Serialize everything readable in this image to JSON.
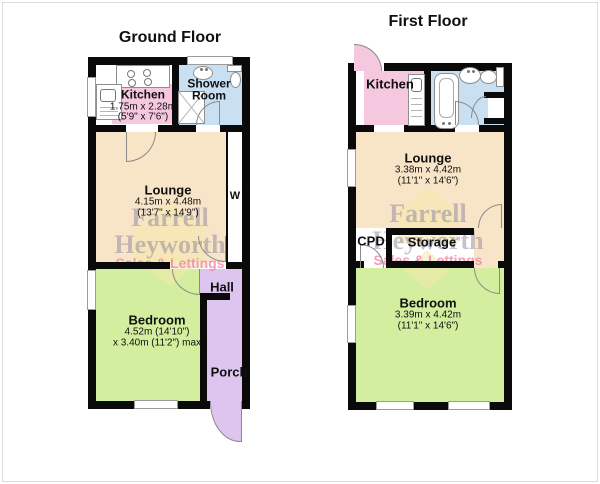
{
  "ground_floor": {
    "title": "Ground Floor",
    "rooms": {
      "kitchen": {
        "name": "Kitchen",
        "dims_m": "1.75m x 2.28m",
        "dims_ft": "(5'9\" x 7'6\")"
      },
      "shower_room": {
        "name_line1": "Shower",
        "name_line2": "Room"
      },
      "lounge": {
        "name": "Lounge",
        "dims_m": "4.15m x 4.48m",
        "dims_ft": "(13'7\" x 14'9\")"
      },
      "bedroom": {
        "name": "Bedroom",
        "dims_line1": "4.52m (14'10\")",
        "dims_line2": "x 3.40m (11'2\") max"
      },
      "hall": {
        "name": "Hall"
      },
      "porch": {
        "name": "Porch"
      },
      "wardrobe": {
        "name": "W"
      }
    }
  },
  "first_floor": {
    "title": "First Floor",
    "rooms": {
      "kitchen": {
        "name": "Kitchen"
      },
      "lounge": {
        "name": "Lounge",
        "dims_m": "3.38m x 4.42m",
        "dims_ft": "(11'1\" x 14'6\")"
      },
      "cpd": {
        "name": "CPD"
      },
      "storage": {
        "name": "Storage"
      },
      "bedroom": {
        "name": "Bedroom",
        "dims_m": "3.39m x 4.42m",
        "dims_ft": "(11'1\" x 14'6\")"
      }
    }
  },
  "watermark": {
    "line1": "Farrell",
    "line2": "Heyworth",
    "tagline": "Sales & Lettings"
  },
  "colors": {
    "wall": "#0a0a0a",
    "kitchen_pink": "#f5c8e0",
    "bathroom_blue": "#c9e0f3",
    "lounge_cream": "#f8e5c8",
    "bedroom_green": "#d3ee9e",
    "hallway_purple": "#ddc5ef",
    "window": "#ffffff",
    "door_line": "#8a8a8a",
    "watermark_gray": "#8d87a0",
    "watermark_pink": "#ee86ad",
    "watermark_yellow": "#f6e8ae"
  }
}
